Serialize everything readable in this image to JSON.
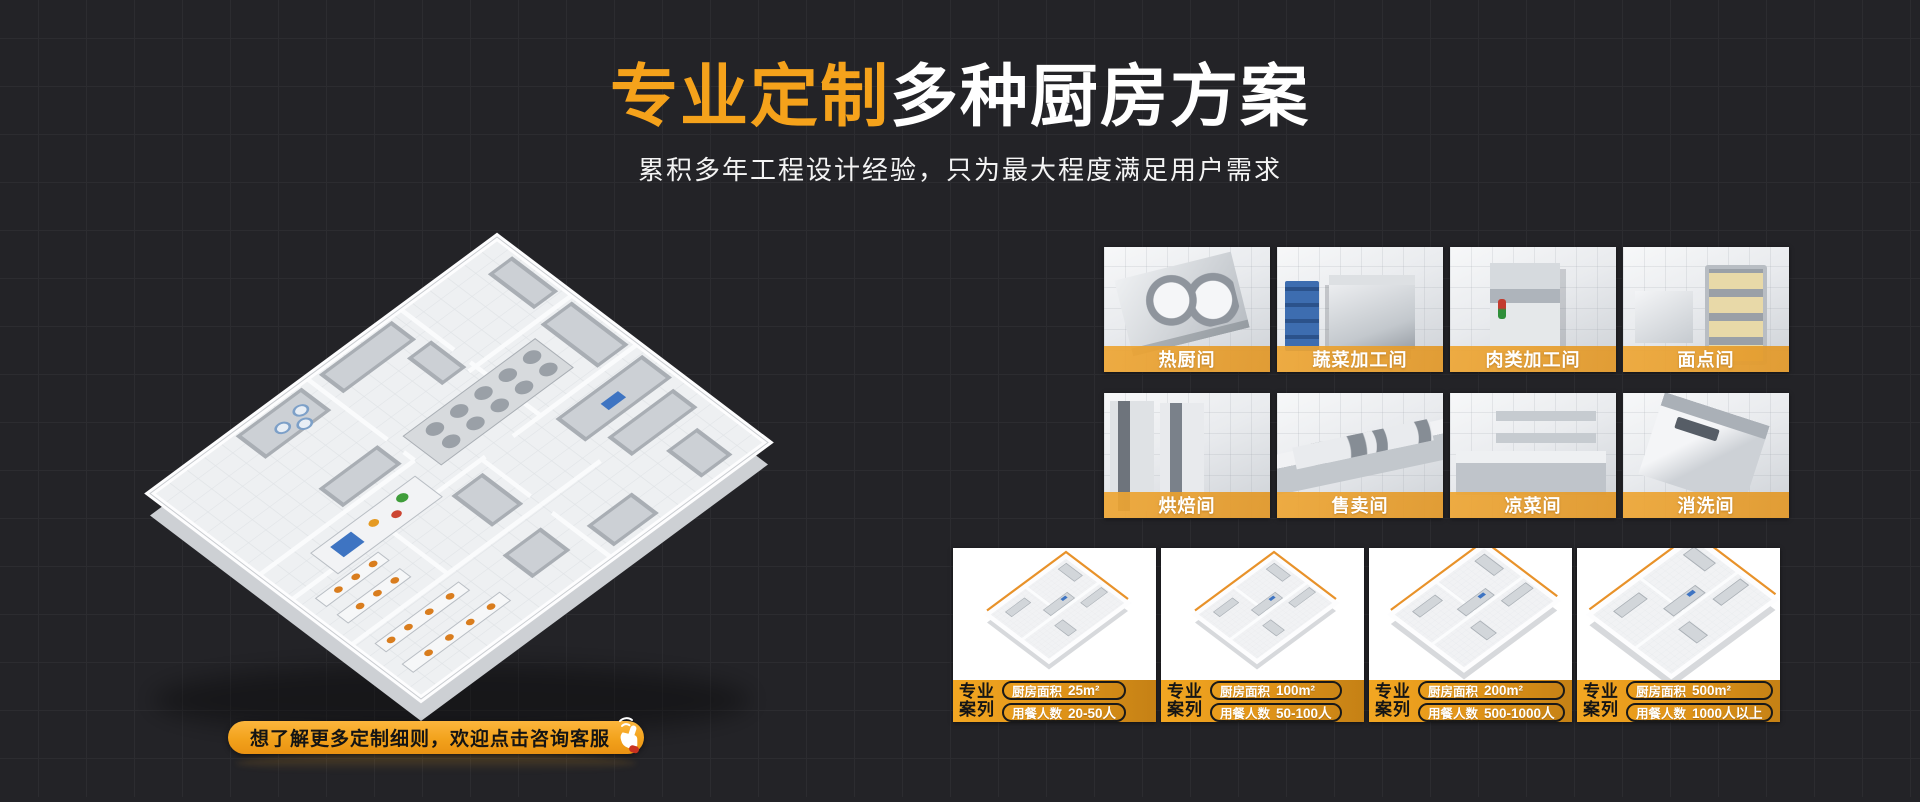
{
  "header": {
    "title_highlight": "专业定制",
    "title_rest": "多种厨房方案",
    "subtitle": "累积多年工程设计经验，只为最大程度满足用户需求"
  },
  "cta": {
    "label": "想了解更多定制细则，欢迎点击咨询客服",
    "icon": "hand-click-icon"
  },
  "rooms": {
    "items": [
      {
        "label": "热厨间"
      },
      {
        "label": "蔬菜加工间"
      },
      {
        "label": "肉类加工间"
      },
      {
        "label": "面点间"
      },
      {
        "label": "烘焙间"
      },
      {
        "label": "售卖间"
      },
      {
        "label": "凉菜间"
      },
      {
        "label": "消洗间"
      }
    ]
  },
  "cases": {
    "badge": "专业\n案列",
    "badge_line1": "专业",
    "badge_line2": "案列",
    "area_label": "厨房面积",
    "diners_label": "用餐人数",
    "items": [
      {
        "area": "25m²",
        "diners": "20-50人"
      },
      {
        "area": "100m²",
        "diners": "50-100人"
      },
      {
        "area": "200m²",
        "diners": "500-1000人"
      },
      {
        "area": "500m²",
        "diners": "1000人以上"
      }
    ]
  },
  "colors": {
    "background": "#232327",
    "grid_line": "#2C2C30",
    "accent_orange": "#F5A21B",
    "label_bar_orange": "#E9A234",
    "case_bar_gradient_start": "#F3A722",
    "case_bar_gradient_end": "#C58115",
    "title_white": "#FFFFFF"
  }
}
